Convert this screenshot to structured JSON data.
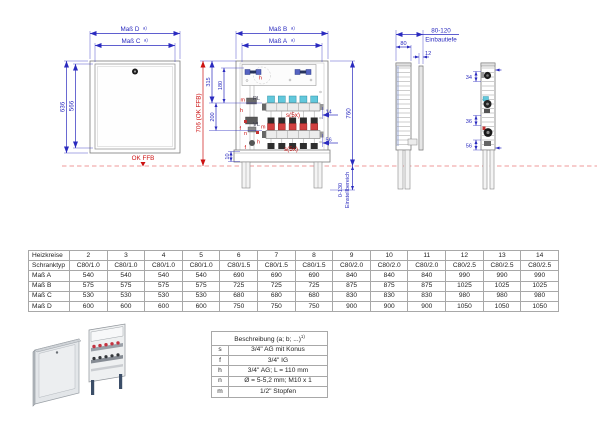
{
  "page": {
    "background": "#ffffff"
  },
  "colors": {
    "dimension_blue": "#2a2abf",
    "annotation_red": "#cc1111",
    "ffb_dash_red": "#ef9a9a",
    "actuator_cyan": "#62c8dc",
    "actuator_red": "#d04040",
    "outline_gray": "#7a7a7a"
  },
  "drawing": {
    "front_view": {
      "mass_d": "Maß D",
      "mass_c": "Maß C",
      "footnote": "a)",
      "outer_height": "636",
      "inner_height": "566",
      "floor_label": "OK FFB"
    },
    "open_view": {
      "mass_b": "Maß B",
      "mass_a": "Maß A",
      "footnote": "a)",
      "dim_315": "315",
      "dim_180": "180",
      "dim_200": "200",
      "dim_10": "10",
      "dim_706": "706 (OK FFB)",
      "dim_14": "14",
      "dim_56": "56",
      "dim_760": "760",
      "adjust_range": "0-130",
      "adjust_label": "Einstellbereich",
      "return_label": "RL",
      "supply_label": "VL",
      "valve_count": "s(5x)",
      "pos_h": "h",
      "pos_m": "m",
      "pos_f": "f",
      "pos_n": "n"
    },
    "side_view": {
      "depth_range": "80-120",
      "depth_label": "Einbautiefe",
      "dim_80": "80",
      "dim_12": "12"
    },
    "section_view": {
      "dim_34": "34",
      "dim_36": "36",
      "dim_56": "56"
    }
  },
  "dims_table": {
    "rows": [
      [
        "Heizkreise",
        "2",
        "3",
        "4",
        "5",
        "6",
        "7",
        "8",
        "9",
        "10",
        "11",
        "12",
        "13",
        "14"
      ],
      [
        "Schranktyp",
        "C80/1.0",
        "C80/1.0",
        "C80/1.0",
        "C80/1.0",
        "C80/1.5",
        "C80/1.5",
        "C80/1.5",
        "C80/2.0",
        "C80/2.0",
        "C80/2.0",
        "C80/2.5",
        "C80/2.5",
        "C80/2.5"
      ],
      [
        "Maß A",
        "540",
        "540",
        "540",
        "540",
        "690",
        "690",
        "690",
        "840",
        "840",
        "840",
        "990",
        "990",
        "990"
      ],
      [
        "Maß B",
        "575",
        "575",
        "575",
        "575",
        "725",
        "725",
        "725",
        "875",
        "875",
        "875",
        "1025",
        "1025",
        "1025"
      ],
      [
        "Maß C",
        "530",
        "530",
        "530",
        "530",
        "680",
        "680",
        "680",
        "830",
        "830",
        "830",
        "980",
        "980",
        "980"
      ],
      [
        "Maß D",
        "600",
        "600",
        "600",
        "600",
        "750",
        "750",
        "750",
        "900",
        "900",
        "900",
        "1050",
        "1050",
        "1050"
      ]
    ]
  },
  "legend": {
    "title": "Beschreibung (a; b; ...)",
    "title_sup": "1)",
    "items": [
      {
        "key": "s",
        "desc": "3/4\" AG mit Konus"
      },
      {
        "key": "f",
        "desc": "3/4\" IG"
      },
      {
        "key": "h",
        "desc": "3/4\" AG; L = 110 mm"
      },
      {
        "key": "n",
        "desc": "Ø = 5-5,2 mm; M10 x 1"
      },
      {
        "key": "m",
        "desc": "1/2\" Stopfen"
      }
    ]
  }
}
